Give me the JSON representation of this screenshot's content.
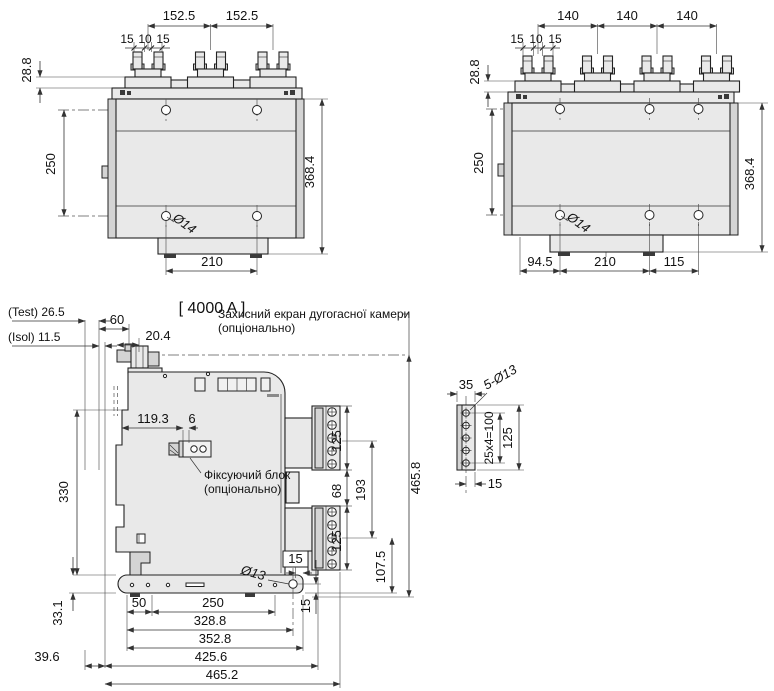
{
  "title": "[ 4000 A ]",
  "colors": {
    "line": "#222222",
    "body_fill": "#e9e9e9",
    "shade_fill": "#d4d4d4",
    "background": "#ffffff"
  },
  "front3": {
    "pitch": [
      "152.5",
      "152.5"
    ],
    "pads": [
      "15",
      "10",
      "15"
    ],
    "d28": "28.8",
    "d250": "250",
    "d368": "368.4",
    "hole": "Ø14",
    "bottom": [
      "210"
    ]
  },
  "front4": {
    "pitch": [
      "140",
      "140",
      "140"
    ],
    "pads": [
      "15",
      "10",
      "15"
    ],
    "d28": "28.8",
    "d250": "250",
    "d368": "368.4",
    "hole": "Ø14",
    "bottom": [
      "94.5",
      "210",
      "115"
    ]
  },
  "side": {
    "test": "(Test) 26.5",
    "isol": "(Isol) 11.5",
    "d60": "60",
    "d204": "20.4",
    "screen1": "Захисний екран дугогасної камери",
    "screen2": "(опціонально)",
    "d1193": "119.3",
    "d6": "6",
    "fix1": "Фіксуючий блок",
    "fix2": "(опціонально)",
    "d330": "330",
    "d331": "33.1",
    "d396": "39.6",
    "d125a": "125",
    "d68": "68",
    "d193": "193",
    "d125b": "125",
    "d1075": "107.5",
    "d4658": "465.8",
    "d15box": "15",
    "d15v": "15",
    "hole": "Ø13",
    "chain": [
      "50",
      "250",
      "328.8",
      "352.8",
      "425.6",
      "465.2"
    ]
  },
  "plate": {
    "d35": "35",
    "holes": "5-Ø13",
    "d25x4": "25x4=100",
    "d125": "125",
    "d15": "15"
  }
}
